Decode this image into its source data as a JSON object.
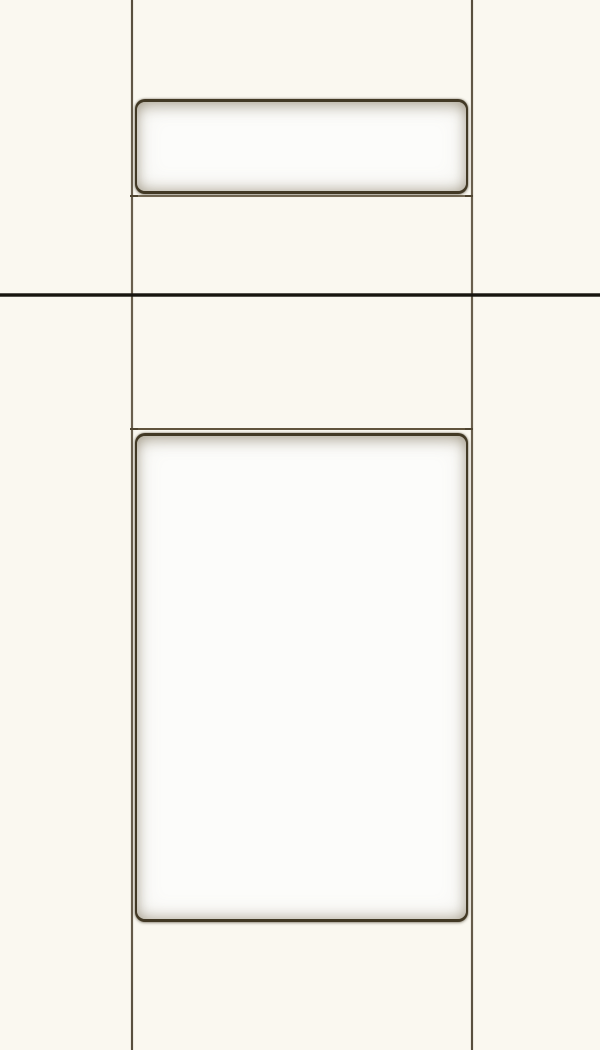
{
  "scene": {
    "description": "Close-up product photo of an off-white painted cabinet: a drawer front (top, cropped) above a matching door (bottom, cropped). Each front is a soft pillowed white slab recessed inside a dark groove outline on a cream frame. A thin near-black horizontal accent line spans the full image width in the upper third.",
    "objects": [
      "drawer-front-slab",
      "door-slab",
      "cabinet-left-edge-line",
      "cabinet-right-edge-line",
      "drawer-door-reveal-line",
      "door-top-reveal-line",
      "accent-divider-line"
    ]
  },
  "colors": {
    "background": "#faf8f0",
    "slab_face_white": "#fcfcfa",
    "groove_dark": "#423925",
    "edge_line": "#695f4d",
    "reveal_line_top": "#786d58",
    "reveal_line_bottom": "#60543d",
    "accent_line": "#17150f",
    "shadow_tint": "#938a75"
  }
}
